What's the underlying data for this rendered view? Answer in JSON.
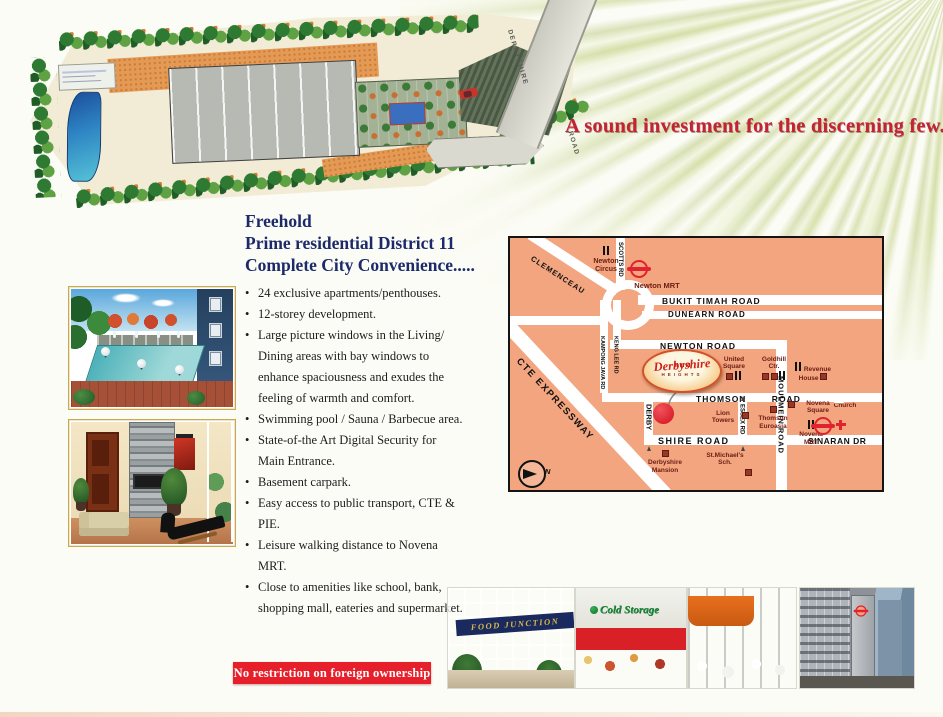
{
  "tagline": "A sound investment for the discerning few.",
  "siteplan": {
    "road_name_1": "DERBYSHIRE",
    "road_name_2": "ROAD"
  },
  "heading": {
    "line1": "Freehold",
    "line2": "Prime residential District 11",
    "line3": "Complete City Convenience....."
  },
  "features": [
    "24 exclusive apartments/penthouses.",
    "12-storey development.",
    "Large picture windows in the Living/ Dining areas with bay windows to enhance spaciousness and exudes the feeling of warmth and comfort.",
    "Swimming pool / Sauna / Barbecue area.",
    "State-of-the Art Digital Security for Main Entrance.",
    "Basement carpark.",
    "Easy access to public transport, CTE & PIE.",
    "Leisure walking distance to Novena MRT.",
    "Close to amenities like school, bank, shopping mall, eateries and supermarket."
  ],
  "banner": "No restriction on foreign ownership",
  "map": {
    "logo": {
      "name": "Derbyshire",
      "sub": "HEIGHTS"
    },
    "roads": {
      "clemenceau": "CLEMENCEAU",
      "scotts": "SCOTTS RD",
      "bukit_timah": "BUKIT TIMAH ROAD",
      "dunearn": "DUNEARN ROAD",
      "newton": "NEWTON ROAD",
      "kampong_java": "KAMPONG JAVA RD",
      "keng_lee": "KENG LEE RD",
      "cte": "CTE EXPRESSWAY",
      "thomson": "THOMSON ROAD",
      "derby": "DERBY",
      "shire": "SHIRE ROAD",
      "essex": "ESSEX RD",
      "moulmein": "MOULMEIN ROAD",
      "sinaran": "SINARAN DR"
    },
    "landmarks": {
      "newton_circus": "Newton Circus",
      "newton_mrt": "Newton MRT",
      "united_square": "United Square",
      "goldhill": "Goldhill Ctr.",
      "revenue_house": "Revenue House",
      "lion_towers": "Lion Towers",
      "thomson_euroasia": "Thomson Euroasia",
      "novena_square": "Novena Square",
      "church": "Church",
      "novena_mrt": "Novena MRT",
      "st_michaels": "St.Michael's Sch.",
      "derbyshire_mansion": "Derbyshire Mansion"
    },
    "compass_label": "N",
    "colors": {
      "background": "#f2a57e",
      "road": "#ffffff",
      "landmark_brown": "#993726",
      "mrt_red": "#e0232e",
      "site_dot_red": "#d40f1e"
    }
  },
  "photo_strip": {
    "food_junction_sign": "FOOD JUNCTION",
    "cold_storage_sign": "Cold Storage"
  },
  "colors": {
    "tagline_red": "#c22433",
    "heading_navy": "#1c2a6a",
    "banner_red": "#e71f2b"
  }
}
